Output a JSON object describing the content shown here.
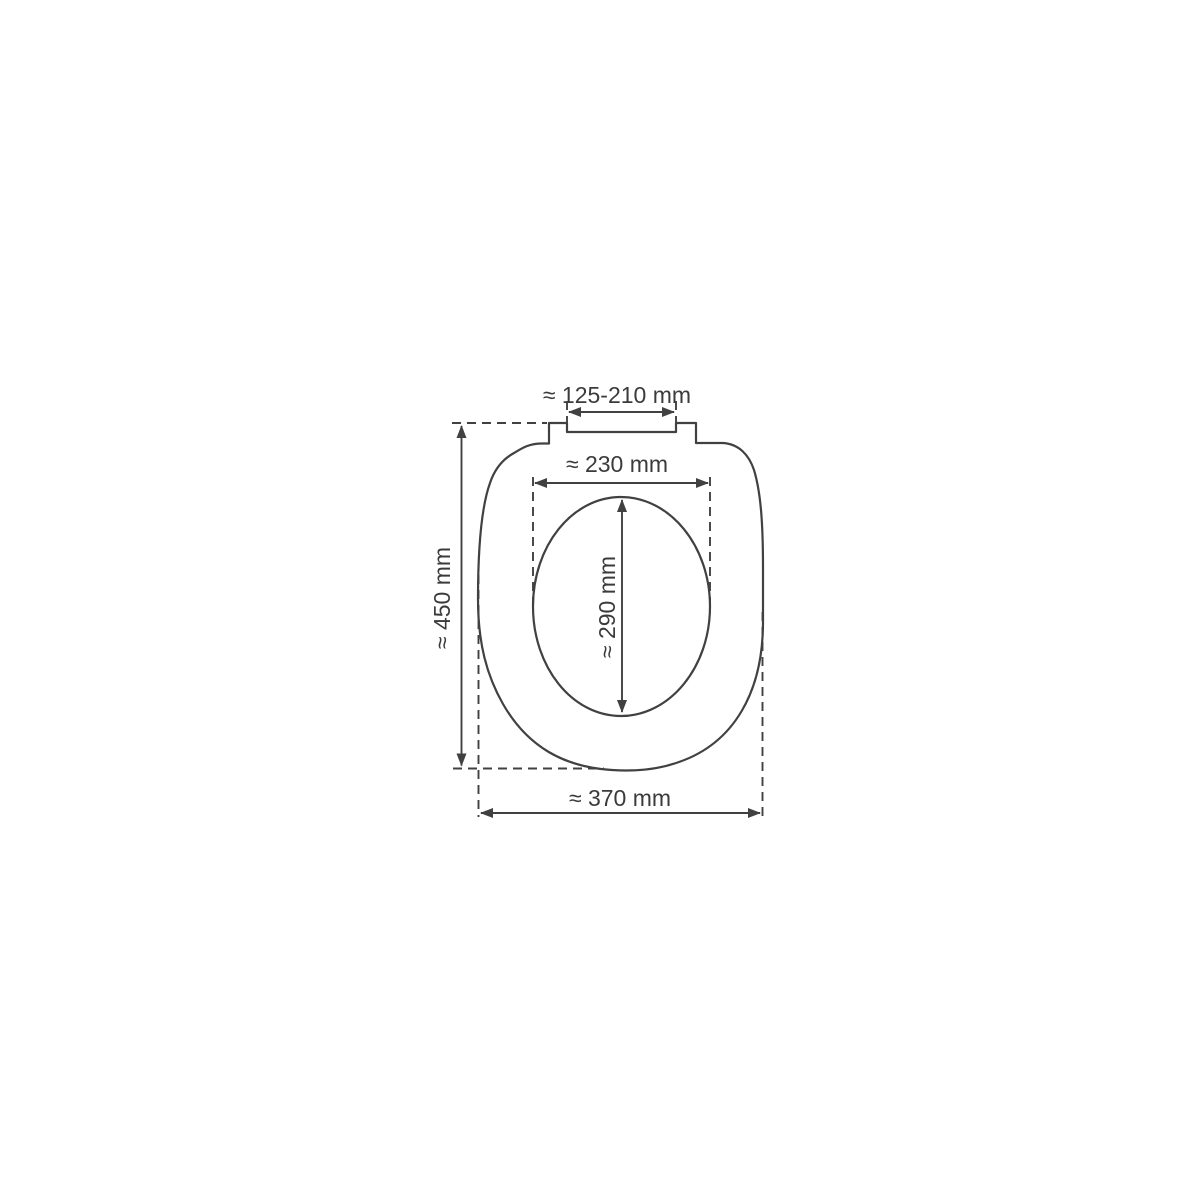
{
  "diagram": {
    "type": "technical-dimension-drawing",
    "subject": "toilet seat with lid, top view, approximate dimensions",
    "unit": "mm",
    "colors": {
      "line": "#414141",
      "text": "#3b3b3b",
      "background": "#ffffff"
    },
    "dimensions": {
      "hinge_width": {
        "label": "≈ 125-210 mm",
        "min": 125,
        "max": 210,
        "unit": "mm"
      },
      "inner_width": {
        "label": "≈ 230 mm",
        "value": 230,
        "unit": "mm"
      },
      "inner_length": {
        "label": "≈ 290 mm",
        "value": 290,
        "unit": "mm"
      },
      "total_length": {
        "label": "≈ 450 mm",
        "value": 450,
        "unit": "mm"
      },
      "total_width": {
        "label": "≈ 370 mm",
        "value": 370,
        "unit": "mm"
      }
    }
  }
}
